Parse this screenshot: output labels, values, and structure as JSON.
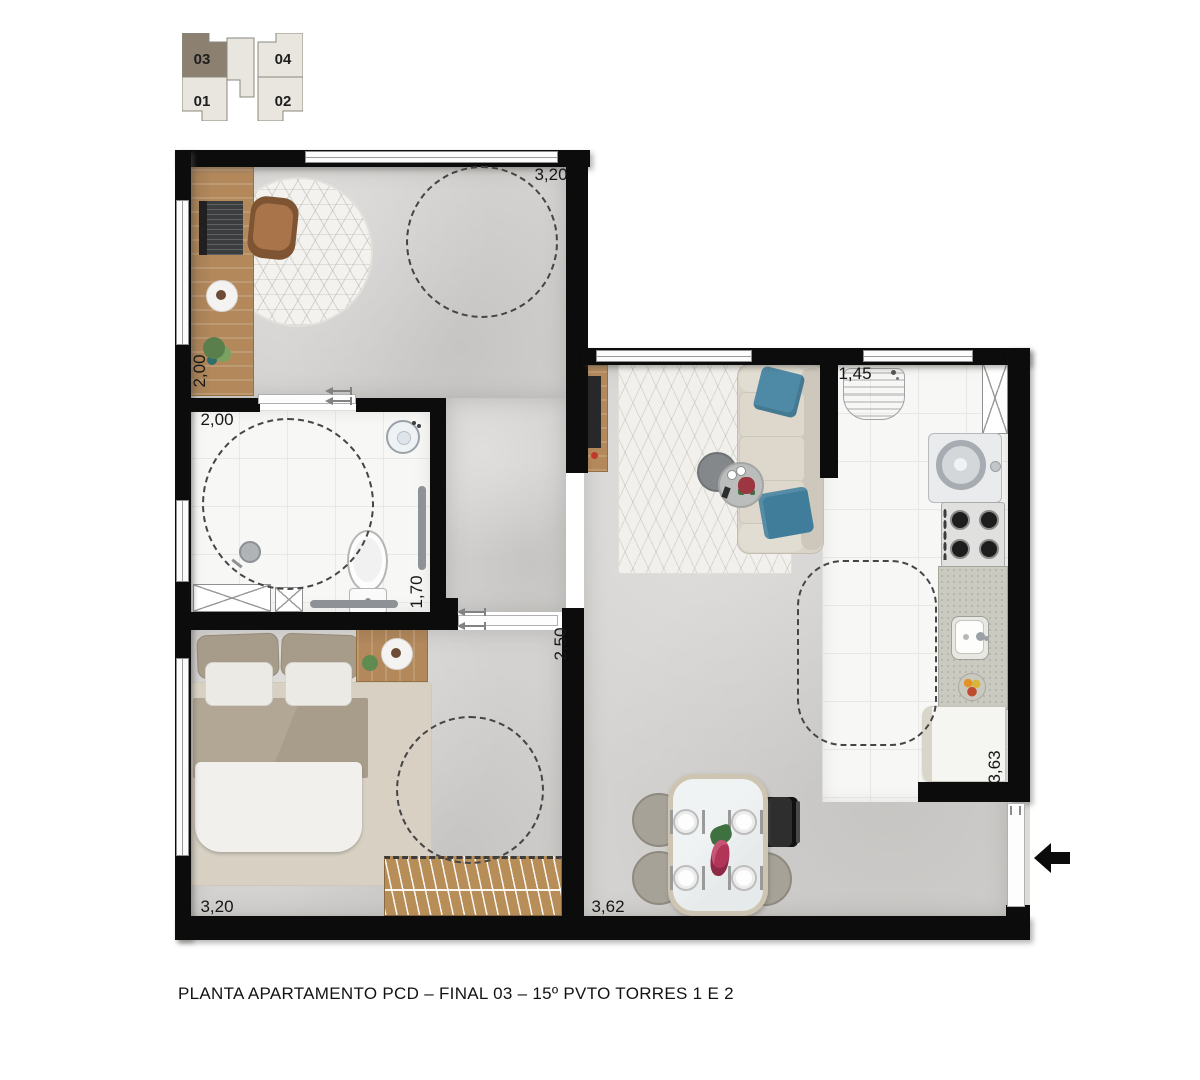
{
  "caption": "PLANTA APARTAMENTO PCD – FINAL 03 – 15º PVTO TORRES 1 E 2",
  "key_plan": {
    "units": [
      {
        "id": "unit-03",
        "label": "03",
        "highlighted": true
      },
      {
        "id": "unit-04",
        "label": "04",
        "highlighted": false
      },
      {
        "id": "unit-01",
        "label": "01",
        "highlighted": false
      },
      {
        "id": "unit-02",
        "label": "02",
        "highlighted": false
      }
    ]
  },
  "dimensions": {
    "office_width": "3,20",
    "office_depth": "2,00",
    "bathroom_width": "2,00",
    "bathroom_depth": "1,70",
    "bedroom_depth": "2,50",
    "laundry_width": "1,45",
    "kitchen_depth": "3,63",
    "bedroom_width": "3,20",
    "living_width": "3,62"
  },
  "icons": {
    "entry_arrow": "left-arrow"
  },
  "colors": {
    "wall": "#0c0c0c",
    "concrete_floor": "#d4d2d0",
    "tile_floor": "#f7f7f5",
    "wood": "#b3895c",
    "key_plan_highlight": "#8c8070",
    "key_plan_unit": "#e9e6df",
    "pillow_blue": "#4e8aa6",
    "dash": "#454545"
  }
}
